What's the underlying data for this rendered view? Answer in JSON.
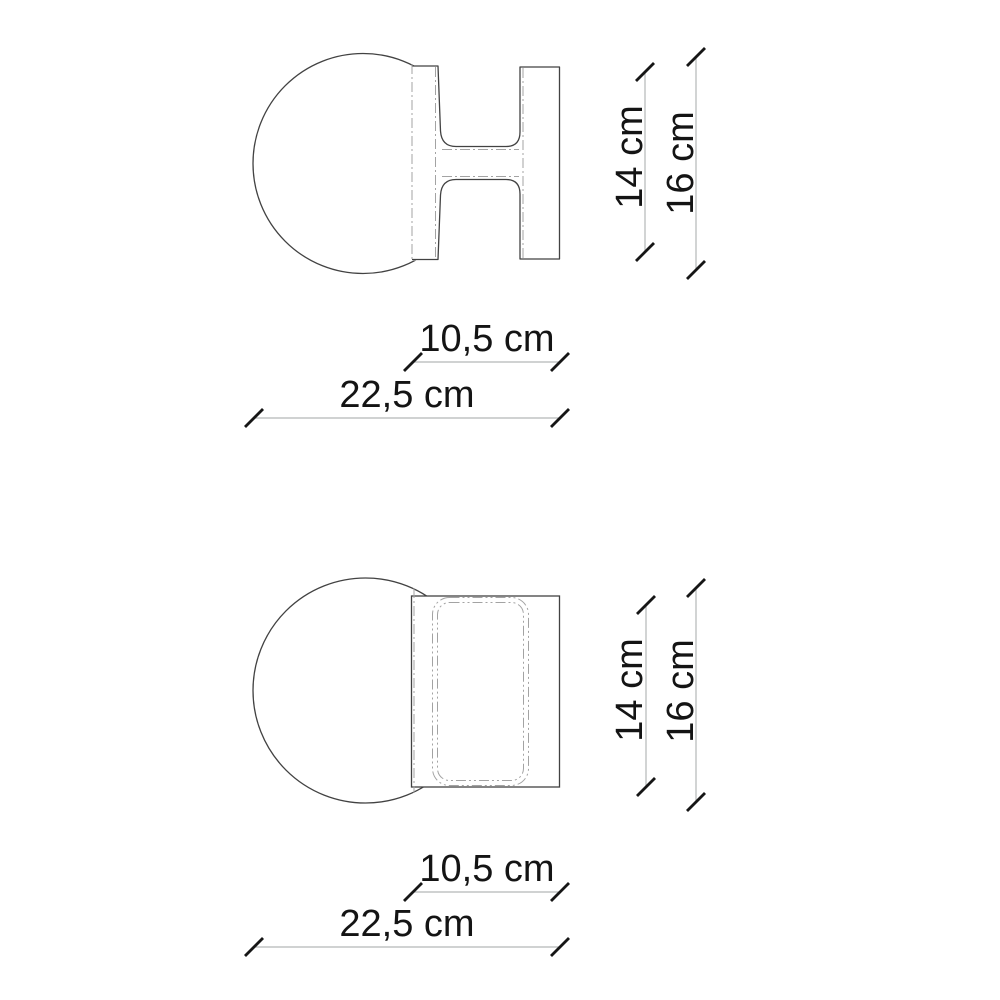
{
  "drawing": {
    "kind": "technical-dimension-drawing",
    "subject": "wall-lamp-globe-with-bracket",
    "colors": {
      "background": "#ffffff",
      "outline": "#424242",
      "dimension_line": "#b4b8b8",
      "hidden_line": "#a3a3a3",
      "tick": "#161616",
      "text": "#141414"
    },
    "views": [
      {
        "name": "top-view",
        "labels": {
          "bracket_height": "14 cm",
          "globe_diameter": "16 cm",
          "bracket_depth": "10,5 cm",
          "total_depth": "22,5 cm"
        }
      },
      {
        "name": "front-view",
        "labels": {
          "bracket_height": "14 cm",
          "globe_diameter": "16 cm",
          "bracket_depth": "10,5 cm",
          "total_depth": "22,5 cm"
        }
      }
    ]
  }
}
